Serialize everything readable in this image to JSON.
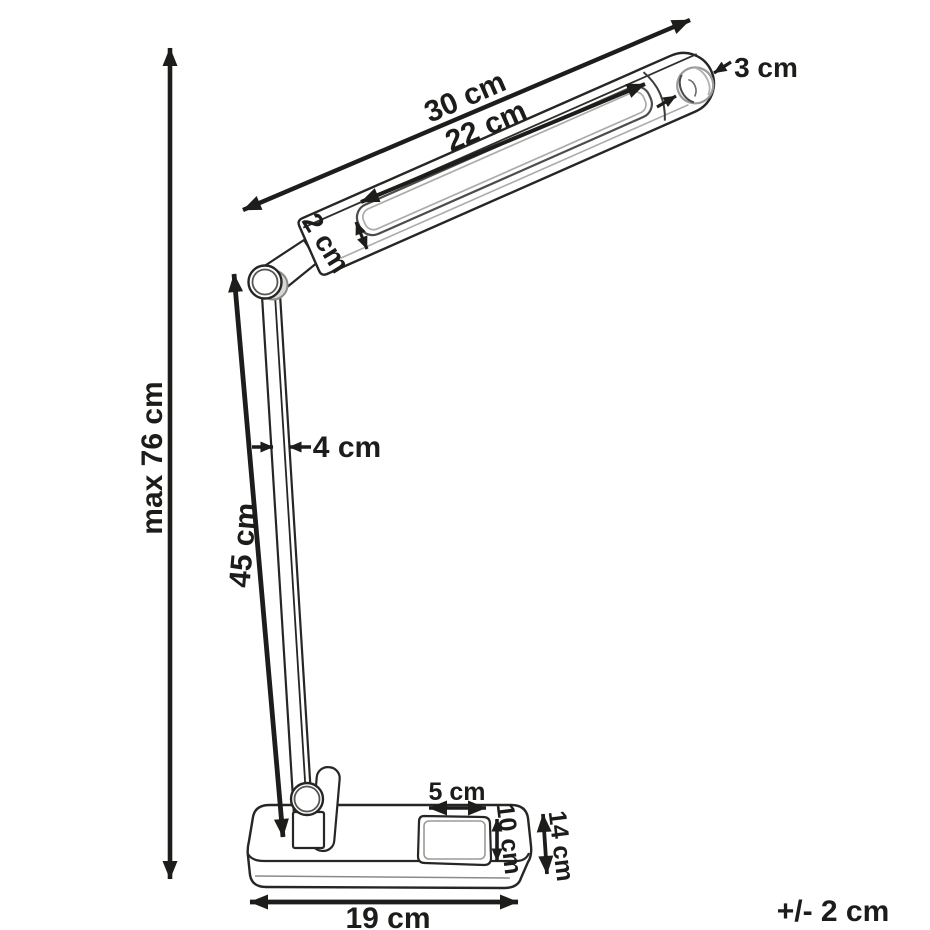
{
  "meta": {
    "description": "Line-art dimension diagram of an articulated LED desk lamp",
    "units": "cm"
  },
  "labels": {
    "max_height": "max 76 cm",
    "head_length": "30 cm",
    "led_panel_length": "22 cm",
    "knob_diameter": "3 cm",
    "head_thickness": "2 cm",
    "arm_width": "4 cm",
    "arm_length": "45 cm",
    "pad_width": "5 cm",
    "pad_depth": "10 cm",
    "base_depth": "14 cm",
    "base_width": "19 cm",
    "tolerance": "+/- 2 cm"
  },
  "colors": {
    "background": "#ffffff",
    "outline": "#262624",
    "dimension": "#1d1d1b",
    "text": "#1c1c1a",
    "secondary_line": "#a8a8a6"
  }
}
